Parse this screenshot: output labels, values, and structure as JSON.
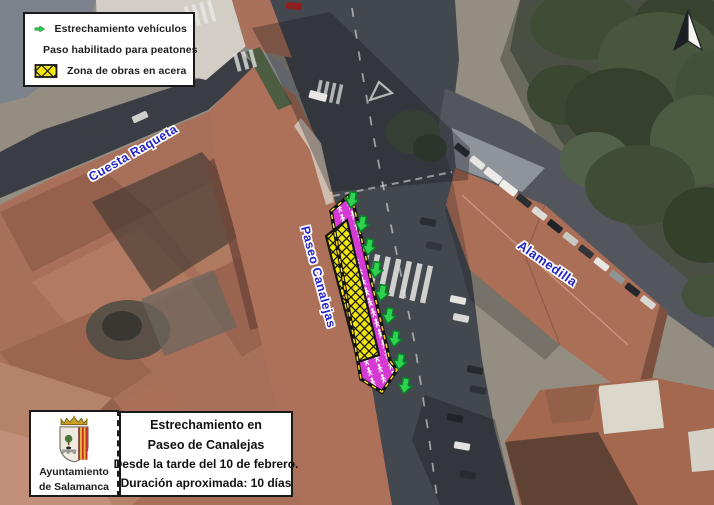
{
  "legend": {
    "items": [
      {
        "label": "Estrechamiento vehículos",
        "icon": "vehicle-narrowing-arrow-icon",
        "color": "#2fd24f"
      },
      {
        "label": "Paso habilitado para peatones",
        "icon": "pedestrian-pass-swatch-icon",
        "color": "#d53bd4"
      },
      {
        "label": "Zona de obras en acera",
        "icon": "works-zone-swatch-icon",
        "color": "#f2e60a"
      }
    ]
  },
  "map": {
    "street_labels": [
      {
        "text": "Cuesta Raqueta"
      },
      {
        "text": "Paseo Canalejas"
      },
      {
        "text": "Alamedilla"
      }
    ],
    "vehicle_arrow_count": 9,
    "colors": {
      "vehicle_arrow": "#2fd24f",
      "pedestrian_zone": "#d53bd4",
      "works_zone": "#f2e60a",
      "zone_border_dash": "#ffd91e",
      "street_label_blue": "#2424c9"
    }
  },
  "notice": {
    "lines": [
      "Estrechamiento en",
      "Paseo de Canalejas",
      "Desde la tarde del 10 de febrero.",
      "Duración aproximada: 10 días"
    ]
  },
  "municipality": {
    "name_line1": "Ayuntamiento",
    "name_line2": "de Salamanca"
  }
}
